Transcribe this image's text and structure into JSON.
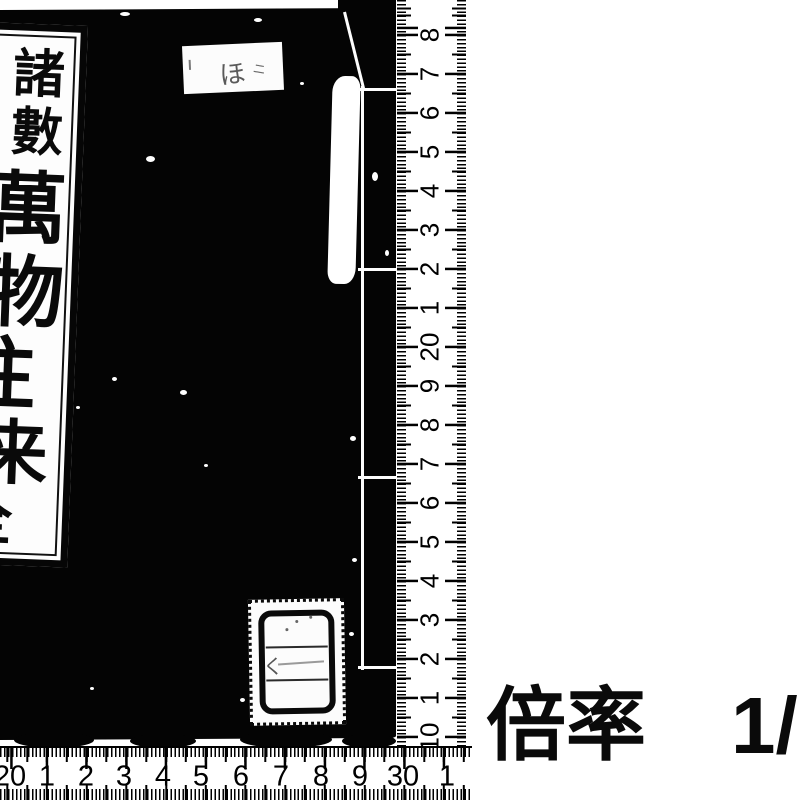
{
  "page": {
    "background_color": "#ffffff",
    "ink_color": "#000000"
  },
  "book": {
    "cover_color": "#040404",
    "title_slip": {
      "text": "諸數萬物往来",
      "volume": "全",
      "chars": [
        {
          "ch": "諸",
          "left": 42,
          "top": 18,
          "size": 52
        },
        {
          "ch": "數",
          "left": 42,
          "top": 76,
          "size": 52
        },
        {
          "ch": "萬",
          "left": 23,
          "top": 140,
          "size": 78
        },
        {
          "ch": "物",
          "left": 23,
          "top": 224,
          "size": 78
        },
        {
          "ch": "往",
          "left": -2,
          "top": 306,
          "size": 78
        },
        {
          "ch": "来",
          "left": 21,
          "top": 388,
          "size": 70
        },
        {
          "ch": "全",
          "left": 2,
          "top": 462,
          "size": 56
        }
      ]
    },
    "top_label": {
      "text": "ほ",
      "marks": "ニ"
    },
    "bottom_sticker": {
      "rows": 3,
      "mark": "く"
    }
  },
  "vertical_ruler": {
    "unit": "cm",
    "orientation": "vertical",
    "labels": [
      {
        "text": "8",
        "y": 35
      },
      {
        "text": "7",
        "y": 74
      },
      {
        "text": "6",
        "y": 113
      },
      {
        "text": "5",
        "y": 152
      },
      {
        "text": "4",
        "y": 191
      },
      {
        "text": "3",
        "y": 230
      },
      {
        "text": "2",
        "y": 269
      },
      {
        "text": "1",
        "y": 308
      },
      {
        "text": "20",
        "y": 347
      },
      {
        "text": "9",
        "y": 386
      },
      {
        "text": "8",
        "y": 425
      },
      {
        "text": "7",
        "y": 464
      },
      {
        "text": "6",
        "y": 503
      },
      {
        "text": "5",
        "y": 542
      },
      {
        "text": "4",
        "y": 581
      },
      {
        "text": "3",
        "y": 620
      },
      {
        "text": "2",
        "y": 659
      },
      {
        "text": "1",
        "y": 698
      },
      {
        "text": "10",
        "y": 737
      }
    ]
  },
  "horizontal_ruler": {
    "unit": "cm",
    "orientation": "horizontal",
    "labels": [
      {
        "text": "20",
        "x": 10
      },
      {
        "text": "1",
        "x": 47
      },
      {
        "text": "2",
        "x": 86
      },
      {
        "text": "3",
        "x": 124
      },
      {
        "text": "4",
        "x": 163
      },
      {
        "text": "5",
        "x": 201
      },
      {
        "text": "6",
        "x": 241
      },
      {
        "text": "7",
        "x": 281
      },
      {
        "text": "8",
        "x": 321
      },
      {
        "text": "9",
        "x": 360
      },
      {
        "text": "30",
        "x": 403
      },
      {
        "text": "1",
        "x": 447
      }
    ]
  },
  "caption": {
    "label": "倍率",
    "value": "1/"
  },
  "wear_speckles": [
    {
      "x": 66,
      "y": 148,
      "w": 7,
      "h": 5
    },
    {
      "x": 146,
      "y": 156,
      "w": 9,
      "h": 6
    },
    {
      "x": 112,
      "y": 377,
      "w": 5,
      "h": 4
    },
    {
      "x": 180,
      "y": 390,
      "w": 7,
      "h": 5
    },
    {
      "x": 204,
      "y": 464,
      "w": 4,
      "h": 3
    },
    {
      "x": 76,
      "y": 406,
      "w": 4,
      "h": 3
    },
    {
      "x": 300,
      "y": 82,
      "w": 4,
      "h": 3
    },
    {
      "x": 372,
      "y": 172,
      "w": 6,
      "h": 9
    },
    {
      "x": 350,
      "y": 436,
      "w": 6,
      "h": 5
    },
    {
      "x": 352,
      "y": 558,
      "w": 5,
      "h": 4
    },
    {
      "x": 349,
      "y": 632,
      "w": 5,
      "h": 4
    },
    {
      "x": 240,
      "y": 698,
      "w": 5,
      "h": 4
    },
    {
      "x": 120,
      "y": 12,
      "w": 10,
      "h": 4
    },
    {
      "x": 254,
      "y": 18,
      "w": 8,
      "h": 4
    },
    {
      "x": 90,
      "y": 687,
      "w": 4,
      "h": 3
    },
    {
      "x": 385,
      "y": 250,
      "w": 4,
      "h": 6
    }
  ]
}
